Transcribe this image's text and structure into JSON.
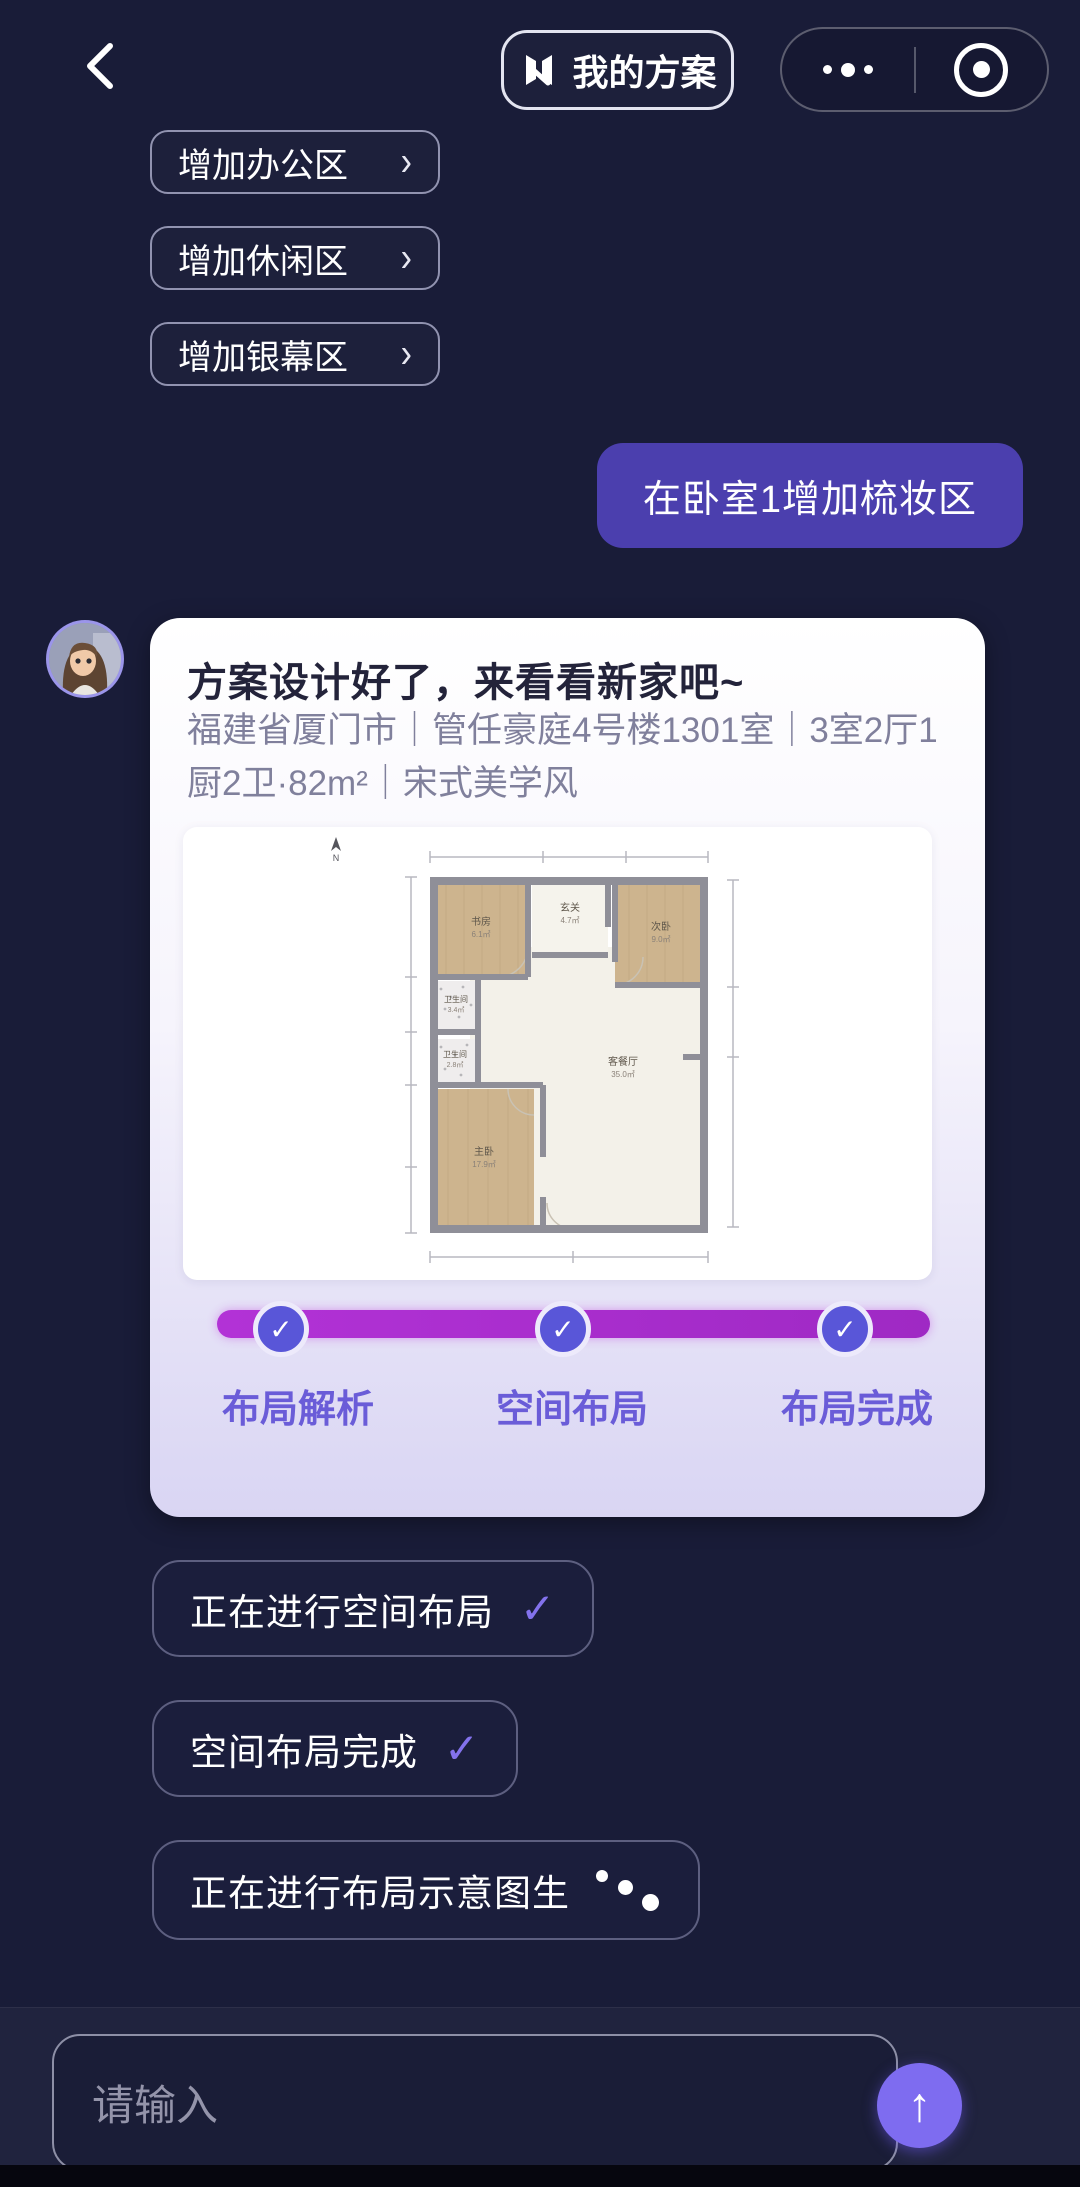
{
  "topbar": {
    "plans_button_label": "我的方案",
    "icons": {
      "back": "chevron-left",
      "more": "ellipsis",
      "record": "target-circle"
    }
  },
  "suggestions": [
    {
      "label": "增加办公区"
    },
    {
      "label": "增加休闲区"
    },
    {
      "label": "增加银幕区"
    }
  ],
  "icons": {
    "chevron": "›",
    "check": "✓",
    "arrow_up": "↑"
  },
  "user_message": "在卧室1增加梳妆区",
  "assistant_card": {
    "title": "方案设计好了，来看看新家吧~",
    "subtitle": "福建省厦门市｜管任豪庭4号楼1301室｜3室2厅1厨2卫·82m²｜宋式美学风",
    "floor_plan": {
      "rooms": [
        {
          "name": "书房",
          "area": "6.1㎡"
        },
        {
          "name": "玄关",
          "area": "4.7㎡"
        },
        {
          "name": "次卧",
          "area": "9.0㎡"
        },
        {
          "name": "卫生间",
          "area": "3.4㎡"
        },
        {
          "name": "卫生间",
          "area": "2.8㎡"
        },
        {
          "name": "主卧",
          "area": "17.9㎡"
        },
        {
          "name": "客餐厅",
          "area": "35.0㎡"
        }
      ],
      "north_label": "N"
    },
    "progress": {
      "steps": [
        {
          "label": "布局解析",
          "done": true
        },
        {
          "label": "空间布局",
          "done": true
        },
        {
          "label": "布局完成",
          "done": true
        }
      ]
    }
  },
  "status_chips": [
    {
      "label": "正在进行空间布局",
      "trailing": "check"
    },
    {
      "label": "空间布局完成",
      "trailing": "check"
    },
    {
      "label": "正在进行布局示意图生",
      "trailing": "typing-dots"
    }
  ],
  "input": {
    "placeholder": "请输入"
  },
  "colors": {
    "background": "#191c38",
    "user_bubble": "#4b3fae",
    "card_bottom": "#d9d5f3",
    "progress_bar": "#a82dcb",
    "check_circle": "#5956d8",
    "step_label": "#6a5cd8",
    "send_button": "#7e6cf0",
    "chip_border": "#5d5f80"
  }
}
